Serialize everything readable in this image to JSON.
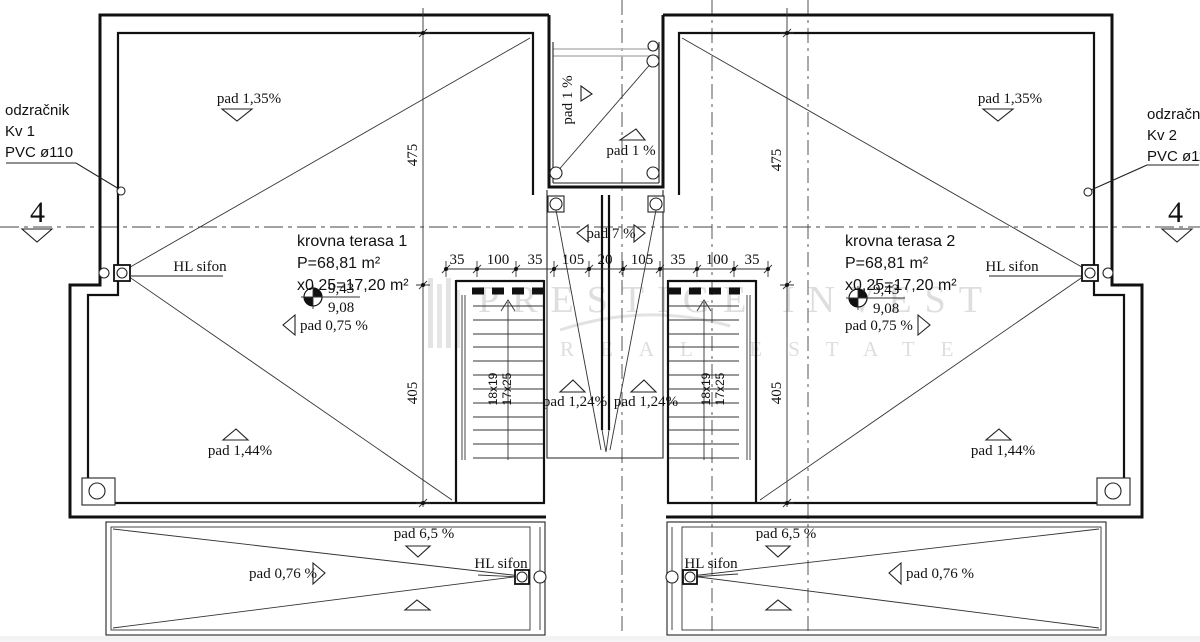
{
  "watermark": {
    "line1": "PRESTIGE INVEST",
    "line2": "REAL ESTATE"
  },
  "section": {
    "left": "4",
    "right": "4"
  },
  "vent_left": {
    "l1": "odzračnik",
    "l2": "Kv 1",
    "l3": "PVC ø110"
  },
  "vent_right": {
    "l1": "odzračnik",
    "l2": "Kv 2",
    "l3": "PVC ø110"
  },
  "terrace1": {
    "title": "krovna terasa 1",
    "area": "P=68,81 m²",
    "coef": "x0,25=17,20 m²",
    "elev_top": "9,43",
    "elev_bot": "9,08",
    "slope_main": "pad 0,75 %",
    "slope_top": "pad 1,35%",
    "slope_bot": "pad 1,44%",
    "siphon": "HL sifon"
  },
  "terrace2": {
    "title": "krovna terasa 2",
    "area": "P=68,81 m²",
    "coef": "x0,25=17,20 m²",
    "elev_top": "9,43",
    "elev_bot": "9,08",
    "slope_main": "pad 0,75 %",
    "slope_top": "pad 1,35%",
    "slope_bot": "pad 1,44%",
    "siphon": "HL sifon"
  },
  "notch": {
    "slope_v": "pad 1 %",
    "slope_h": "pad 1 %"
  },
  "court": {
    "slope": "pad 7 %",
    "slope_l": "pad 1,24%",
    "slope_r": "pad 1,24%"
  },
  "stair_left": {
    "riser": "18x19",
    "tread": "17x25"
  },
  "stair_right": {
    "riser": "18x19",
    "tread": "17x25"
  },
  "dims": {
    "h": [
      "35",
      "100",
      "35",
      "105",
      "20",
      "105",
      "35",
      "100",
      "35"
    ],
    "v_left": [
      "475",
      "405"
    ],
    "v_right": [
      "475",
      "405"
    ]
  },
  "balcony_left": {
    "slope_top": "pad 6,5 %",
    "slope": "pad 0,76 %",
    "siphon": "HL sifon"
  },
  "balcony_right": {
    "slope_top": "pad 6,5 %",
    "slope": "pad 0,76 %",
    "siphon": "HL sifon"
  }
}
